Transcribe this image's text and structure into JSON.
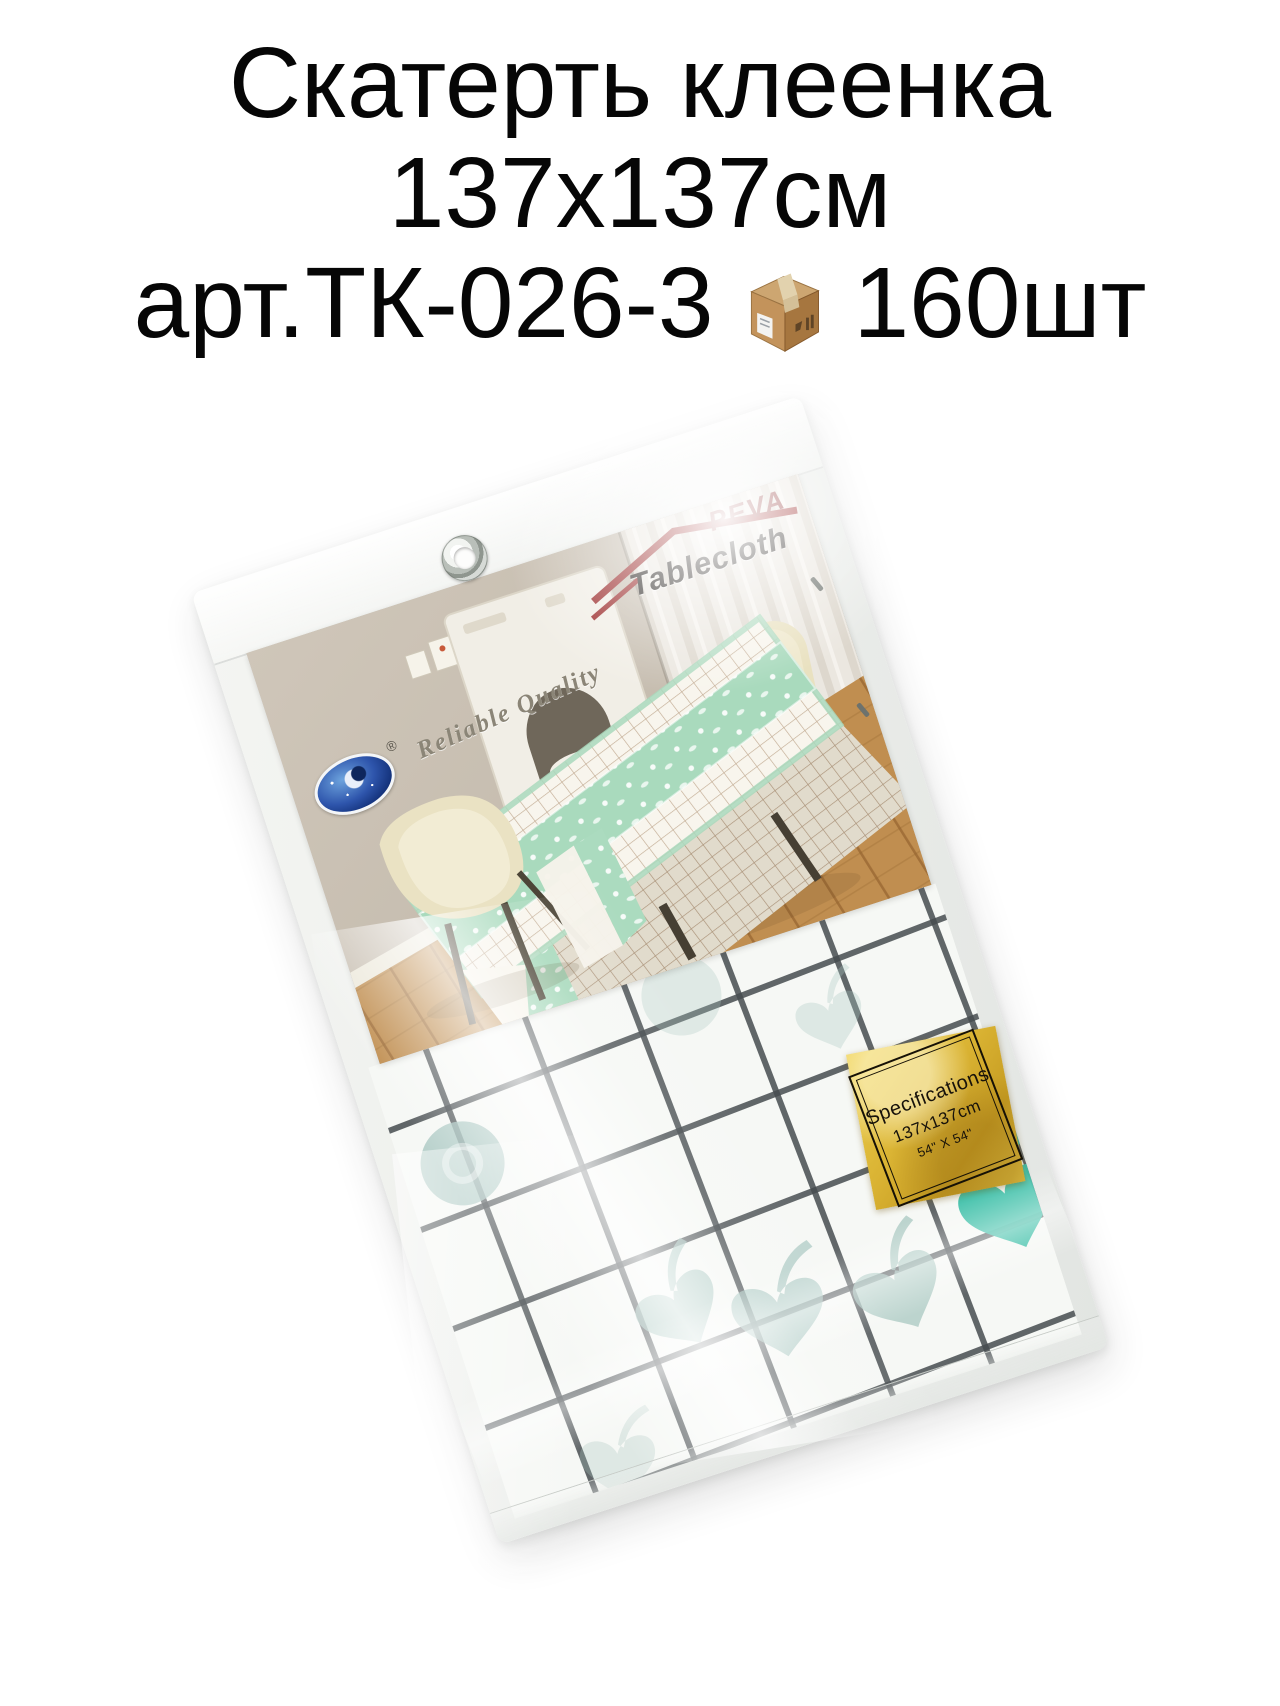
{
  "title": {
    "line1": "Скатерть клеенка",
    "line2": "137х137см",
    "line3_article": "арт.ТК-026-3",
    "line3_count": "160шт",
    "box_icon": "package-box-icon"
  },
  "package_label": {
    "brand_top": "PEVA",
    "brand_main": "Tablecloth",
    "quality_text": "Reliable Quality",
    "registered_mark": "®",
    "logo_icon": "night-sky-oval-logo"
  },
  "spec_sticker": {
    "title": "Specifications",
    "size_cm": "137x137cm",
    "size_inch": "54\" X 54\""
  },
  "colors": {
    "title_text": "#060606",
    "bag_plastic": "#edf0ec",
    "cloth_grid_line": "#4c5254",
    "cloth_teal_shape": "#a9c6c1",
    "cloth_teal_bright": "#3ec0a9",
    "runner_mint": "#a9dabd",
    "sticker_gold": "#d9b232",
    "brand_red": "#962e2e",
    "wood_floor": "#c08e50",
    "wall_taupe": "#c9c0b3",
    "chair_cream": "#eae2c3"
  }
}
